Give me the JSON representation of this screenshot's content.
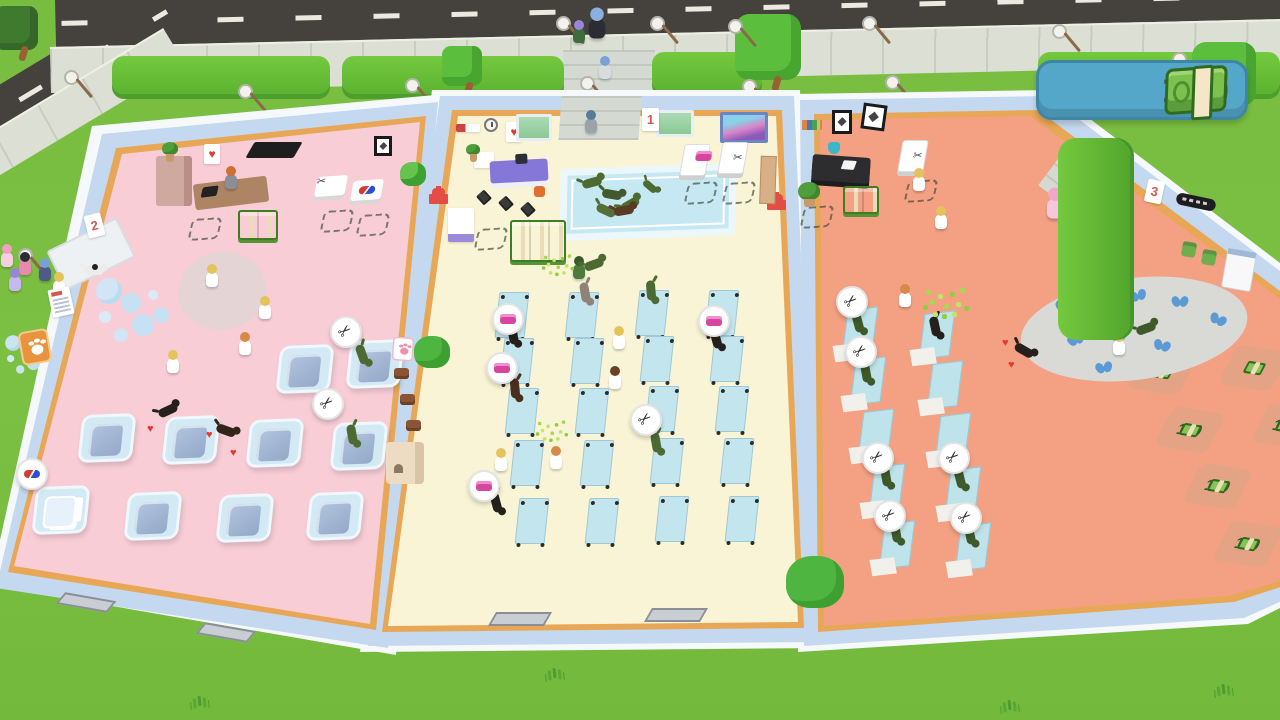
{
  "hud": {
    "money": "160",
    "money_icon": "cash-stack-icon",
    "badge_color": "#54a7c8"
  },
  "icons": {
    "scissors": "✂",
    "heart": "♥",
    "cash_stack": "css-shape",
    "soap_bar": "css-shape",
    "pill_capsule": "css-shape",
    "paw_print": "css-shape"
  },
  "rooms": {
    "bath_room": {
      "sign": "2",
      "floor_color": "#f8cdd6"
    },
    "wash_room": {
      "sign": "1",
      "floor_color": "#f9f4d5"
    },
    "grooming_room": {
      "sign": "3",
      "floor_color": "#f4a083"
    }
  },
  "prices": {
    "left_column": [
      "90",
      "100",
      "150",
      "150"
    ],
    "right_column": [
      "90",
      "100",
      "150",
      "150"
    ]
  },
  "palette": {
    "grass": "#7cc043",
    "road": "#45423d",
    "wall": "#c4d9ef",
    "trim": "#e7a757",
    "bed_blue": "#c3e5ed",
    "price_text": "#245c2d",
    "money_green": "#7cc14e"
  }
}
